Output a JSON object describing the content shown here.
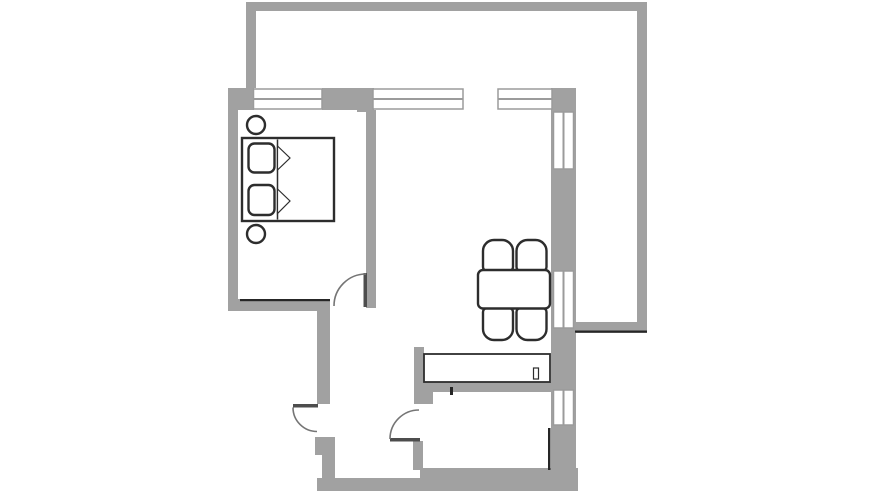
{
  "canvas": {
    "width": 872,
    "height": 491
  },
  "colors": {
    "background": "#ffffff",
    "wall": "#a1a1a1",
    "window_fill": "#ffffff",
    "window_frame": "#9b9b9b",
    "accent": "#262626",
    "door_leaf": "#4d4d4d",
    "door_arc": "#757575",
    "furniture_outline": "#2d2d2d",
    "furniture_fill": "#ffffff"
  },
  "styles": {
    "wall": {
      "fill": "#a1a1a1"
    },
    "accent": {
      "fill": "#262626"
    },
    "leaf": {
      "fill": "#4d4d4d"
    },
    "arc": {
      "fill": "none",
      "stroke": "#757575",
      "sw": 1.6
    },
    "winbox": {
      "fill": "#ffffff",
      "stroke": "#9b9b9b",
      "sw": 1.5
    },
    "winline": {
      "fill": "none",
      "stroke": "#9b9b9b",
      "sw": 2
    },
    "furn": {
      "fill": "#ffffff",
      "stroke": "#2d2d2d",
      "sw": 2.4
    },
    "furnthin": {
      "fill": "#ffffff",
      "stroke": "#2d2d2d",
      "sw": 1.2
    },
    "furnline": {
      "fill": "none",
      "stroke": "#2d2d2d",
      "sw": 1.5
    },
    "counter": {
      "fill": "none",
      "stroke": "#2d2d2d",
      "sw": 1.8
    }
  },
  "shapes": [
    {
      "n": "terrace-wall-top",
      "t": "rect",
      "s": "wall",
      "x": 246,
      "y": 2,
      "w": 401,
      "h": 9
    },
    {
      "n": "terrace-wall-left",
      "t": "rect",
      "s": "wall",
      "x": 246,
      "y": 11,
      "w": 10,
      "h": 77
    },
    {
      "n": "terrace-wall-right",
      "t": "rect",
      "s": "wall",
      "x": 637,
      "y": 2,
      "w": 10,
      "h": 321
    },
    {
      "n": "terrace-wall-bottom",
      "t": "rect",
      "s": "wall",
      "x": 573,
      "y": 322,
      "w": 74,
      "h": 11
    },
    {
      "n": "outer-wall-top-left",
      "t": "rect",
      "s": "wall",
      "x": 228,
      "y": 88,
      "w": 26,
      "h": 22
    },
    {
      "n": "outer-wall-top-mid",
      "t": "rect",
      "s": "wall",
      "x": 322,
      "y": 88,
      "w": 35,
      "h": 22
    },
    {
      "n": "outer-wall-top-block",
      "t": "rect",
      "s": "wall",
      "x": 357,
      "y": 88,
      "w": 17,
      "h": 24
    },
    {
      "n": "outer-wall-left",
      "t": "rect",
      "s": "wall",
      "x": 228,
      "y": 88,
      "w": 10,
      "h": 223
    },
    {
      "n": "bedroom-south-wall",
      "t": "rect",
      "s": "wall",
      "x": 228,
      "y": 299,
      "w": 93,
      "h": 12
    },
    {
      "n": "hall-west-wall-upper",
      "t": "rect",
      "s": "wall",
      "x": 317,
      "y": 299,
      "w": 13,
      "h": 105
    },
    {
      "n": "hall-west-wall-lower",
      "t": "rect",
      "s": "wall",
      "x": 315,
      "y": 437,
      "w": 20,
      "h": 18
    },
    {
      "n": "hall-west-wall-foot",
      "t": "rect",
      "s": "wall",
      "x": 322,
      "y": 455,
      "w": 13,
      "h": 25
    },
    {
      "n": "bedroom-living-divider-wall",
      "t": "rect",
      "s": "wall",
      "x": 366,
      "y": 110,
      "w": 10,
      "h": 198
    },
    {
      "n": "hall-kitchen-wall-upper",
      "t": "rect",
      "s": "wall",
      "x": 414,
      "y": 347,
      "w": 10,
      "h": 57
    },
    {
      "n": "kitchen-north-wall-corner",
      "t": "rect",
      "s": "wall",
      "x": 414,
      "y": 382,
      "w": 19,
      "h": 22
    },
    {
      "n": "hall-kitchen-wall-lower",
      "t": "rect",
      "s": "wall",
      "x": 413,
      "y": 441,
      "w": 10,
      "h": 29
    },
    {
      "n": "kitchen-north-wall",
      "t": "rect",
      "s": "wall",
      "x": 414,
      "y": 382,
      "w": 140,
      "h": 10
    },
    {
      "n": "kitchen-south-wall",
      "t": "rect",
      "s": "wall",
      "x": 420,
      "y": 468,
      "w": 158,
      "h": 12
    },
    {
      "n": "outer-wall-bottom",
      "t": "rect",
      "s": "wall",
      "x": 317,
      "y": 478,
      "w": 261,
      "h": 13
    },
    {
      "n": "outer-wall-right",
      "t": "rect",
      "s": "wall",
      "x": 551,
      "y": 88,
      "w": 25,
      "h": 403
    },
    {
      "n": "window-bedroom-frame",
      "t": "rect",
      "s": "winbox",
      "x": 253.5,
      "y": 89,
      "w": 68.5,
      "h": 20
    },
    {
      "n": "window-bedroom-mullion",
      "t": "path",
      "s": "winline",
      "d": "M 253.5,99 L 322,99"
    },
    {
      "n": "window-living-frame",
      "t": "rect",
      "s": "winbox",
      "x": 373,
      "y": 89,
      "w": 90,
      "h": 20
    },
    {
      "n": "window-living-mullion",
      "t": "path",
      "s": "winline",
      "d": "M 373,99 L 463,99"
    },
    {
      "n": "window-living2-frame",
      "t": "rect",
      "s": "winbox",
      "x": 498,
      "y": 89,
      "w": 54,
      "h": 20
    },
    {
      "n": "window-living2-mullion",
      "t": "path",
      "s": "winline",
      "d": "M 498,99 L 552,99"
    },
    {
      "n": "window-east1-frame",
      "t": "rect",
      "s": "winbox",
      "x": 553.5,
      "y": 112,
      "w": 20,
      "h": 57
    },
    {
      "n": "window-east1-mullion",
      "t": "path",
      "s": "winline",
      "d": "M 563.5,112 L 563.5,169"
    },
    {
      "n": "window-east2-frame",
      "t": "rect",
      "s": "winbox",
      "x": 553.5,
      "y": 271,
      "w": 20,
      "h": 57
    },
    {
      "n": "window-east2-mullion",
      "t": "path",
      "s": "winline",
      "d": "M 563.5,271 L 563.5,328"
    },
    {
      "n": "window-east3-frame",
      "t": "rect",
      "s": "winbox",
      "x": 553.5,
      "y": 390,
      "w": 20,
      "h": 35
    },
    {
      "n": "window-east3-mullion",
      "t": "path",
      "s": "winline",
      "d": "M 563.5,390 L 563.5,425"
    },
    {
      "n": "bedroom-wall-edge-line",
      "t": "rect",
      "s": "accent",
      "x": 240,
      "y": 299,
      "w": 90,
      "h": 2.2
    },
    {
      "n": "terrace-wall-edge-line",
      "t": "rect",
      "s": "accent",
      "x": 575,
      "y": 330.5,
      "w": 72,
      "h": 2.2
    },
    {
      "n": "kitchen-east-wall-edge-line",
      "t": "rect",
      "s": "accent",
      "x": 548,
      "y": 428,
      "w": 2.5,
      "h": 42
    },
    {
      "n": "kitchen-north-wall-stub",
      "t": "rect",
      "s": "accent",
      "x": 450,
      "y": 387,
      "w": 3,
      "h": 8
    },
    {
      "n": "bedroom-door-leaf",
      "t": "rect",
      "s": "leaf",
      "x": 363.5,
      "y": 273,
      "w": 3.5,
      "h": 34
    },
    {
      "n": "bedroom-door-swing",
      "t": "path",
      "s": "arc",
      "d": "M 366,274 A 32 32 0 0 0 334,306"
    },
    {
      "n": "entry-door-leaf",
      "t": "rect",
      "s": "leaf",
      "x": 293,
      "y": 404,
      "w": 25,
      "h": 3.5
    },
    {
      "n": "entry-door-swing",
      "t": "path",
      "s": "arc",
      "d": "M 293,407.5 A 24 24 0 0 0 317,431.5"
    },
    {
      "n": "kitchen-door-leaf",
      "t": "rect",
      "s": "leaf",
      "x": 390,
      "y": 438,
      "w": 30,
      "h": 3.5
    },
    {
      "n": "kitchen-door-swing",
      "t": "path",
      "s": "arc",
      "d": "M 419,410 A 29 29 0 0 0 390,439"
    },
    {
      "n": "nightstand-top",
      "t": "circle",
      "s": "furn",
      "cx": 256,
      "cy": 125,
      "r": 9
    },
    {
      "n": "nightstand-bottom",
      "t": "circle",
      "s": "furn",
      "cx": 256,
      "cy": 234,
      "r": 9
    },
    {
      "n": "bed",
      "t": "rect",
      "s": "furn",
      "x": 242,
      "y": 138,
      "w": 92,
      "h": 83
    },
    {
      "n": "pillow-top",
      "t": "rect",
      "s": "furn",
      "x": 248.5,
      "y": 143.5,
      "w": 26,
      "h": 29,
      "rx": 6
    },
    {
      "n": "pillow-bottom",
      "t": "rect",
      "s": "furn",
      "x": 248.5,
      "y": 185,
      "w": 26,
      "h": 30,
      "rx": 6
    },
    {
      "n": "blanket-edge-line",
      "t": "path",
      "s": "furnline",
      "d": "M 277.5,139.5 L 277.5,219.5"
    },
    {
      "n": "blanket-fold-top",
      "t": "polygon",
      "s": "furnthin",
      "p": "277.5,146 290,158 277.5,170"
    },
    {
      "n": "blanket-fold-bottom",
      "t": "polygon",
      "s": "furnthin",
      "p": "277.5,189 290,201 277.5,213.5"
    },
    {
      "n": "chair-top-left",
      "t": "path",
      "s": "furn",
      "d": "M 483,251 a 11,11 0 0 1 11,-11 l 8,0 a 11,11 0 0 1 11,11 l 0,16 a 4,4 0 0 1 -4,4 l -22,0 a 4,4 0 0 1 -4,-4 z"
    },
    {
      "n": "chair-top-right",
      "t": "path",
      "s": "furn",
      "d": "M 516.5,251 a 11,11 0 0 1 11,-11 l 8,0 a 11,11 0 0 1 11,11 l 0,16 a 4,4 0 0 1 -4,4 l -22,0 a 4,4 0 0 1 -4,-4 z"
    },
    {
      "n": "chair-bottom-left",
      "t": "path",
      "s": "furn",
      "d": "M 483,312 a 4,4 0 0 1 4,-4 l 22,0 a 4,4 0 0 1 4,4 l 0,17 a 11,11 0 0 1 -11,11 l -8,0 a 11,11 0 0 1 -11,-11 z"
    },
    {
      "n": "chair-bottom-right",
      "t": "path",
      "s": "furn",
      "d": "M 516.5,312 a 4,4 0 0 1 4,-4 l 22,0 a 4,4 0 0 1 4,4 l 0,17 a 11,11 0 0 1 -11,11 l -8,0 a 11,11 0 0 1 -11,-11 z"
    },
    {
      "n": "dining-table",
      "t": "rect",
      "s": "furn",
      "x": 478,
      "y": 270,
      "w": 72,
      "h": 38.5,
      "rx": 5
    },
    {
      "n": "sideboard",
      "t": "rect",
      "s": "counter",
      "x": 424,
      "y": 354,
      "w": 126,
      "h": 28
    },
    {
      "n": "sideboard-divider",
      "t": "rect",
      "s": "furnthin",
      "x": 533.5,
      "y": 368,
      "w": 5,
      "h": 11
    }
  ]
}
